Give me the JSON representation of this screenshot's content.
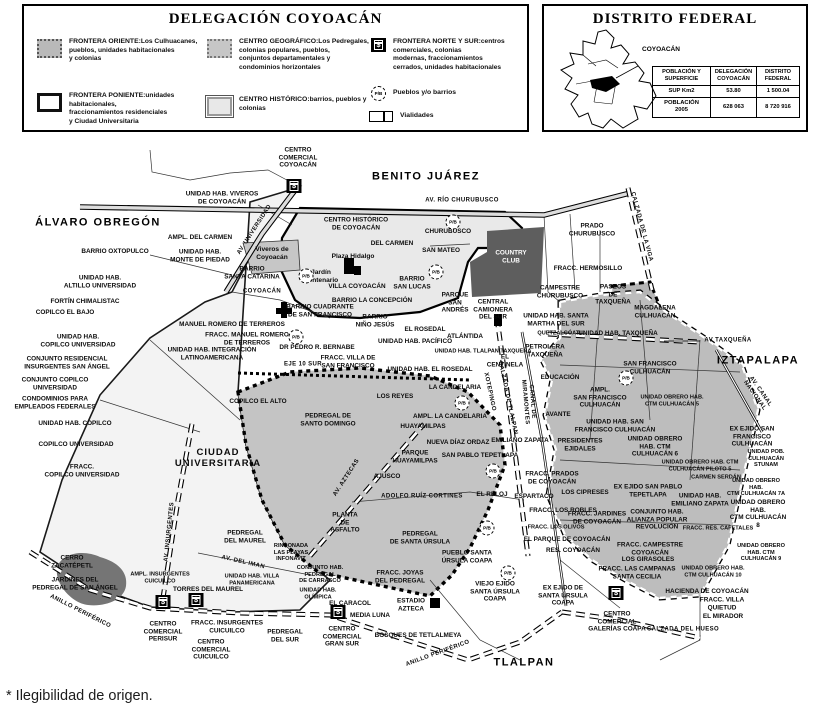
{
  "legend": {
    "title": "DELEGACIÓN COYOACÁN",
    "items": [
      {
        "title": "FRONTERA ORIENTE:",
        "desc": "Los Culhuacanes,\npueblos, unidades habitacionales\ny colonias",
        "color": "#b9b9b9"
      },
      {
        "title": "FRONTERA PONIENTE:",
        "desc": "unidades habitacionales,\nfraccionamientos residenciales\ny Ciudad Universitaria",
        "color": "#ffffff"
      },
      {
        "title": "CENTRO GEOGRÁFICO:",
        "desc": "Los Pedregales,\ncolonias populares, pueblos,\nconjuntos departamentales y\ncondominios horizontales",
        "color": "#c6c6c6"
      },
      {
        "title": "CENTRO HISTÓRICO:",
        "desc": "barrios, pueblos y colonias",
        "color": "#e8e8e8"
      },
      {
        "title": "FRONTERA NORTE Y SUR:",
        "desc": "centros comerciales, colonias\nmodernas, fraccionamientos\ncerrados, unidades habitacionales"
      },
      {
        "title": "Pueblos y/o barrios"
      },
      {
        "title": "Vialidades"
      }
    ],
    "bank_glyph": "$",
    "pb_glyph": "P/B"
  },
  "df_box": {
    "title": "DISTRITO FEDERAL",
    "map_label": "COYOACÁN",
    "table": {
      "headers": [
        "POBLACIÓN Y\nSUPERFICIE",
        "DELEGACIÓN\nCOYOACÁN",
        "DISTRITO\nFEDERAL"
      ],
      "rows": [
        [
          "SUP Km2",
          "53.80",
          "1 500.04"
        ],
        [
          "POBLACIÓN\n2005",
          "628 063",
          "8 720 916"
        ]
      ]
    }
  },
  "footnote": "* Ilegibilidad de origen.",
  "colors": {
    "frontera_oriente": "#bdbdbd",
    "centro_geografico": "#c4c4c4",
    "frontera_poniente": "#f3f3f3",
    "centro_historico": "#e9e9e9",
    "dark_zone": "#5e5e5e"
  },
  "map": {
    "labels": [
      {
        "t": "ÁLVARO OBREGÓN",
        "x": 98,
        "y": 223,
        "k": "d"
      },
      {
        "t": "BENITO JUÁREZ",
        "x": 426,
        "y": 177,
        "k": "d"
      },
      {
        "t": "IZTAPALAPA",
        "x": 758,
        "y": 361,
        "k": "d"
      },
      {
        "t": "TLALPAN",
        "x": 524,
        "y": 663,
        "k": "d"
      },
      {
        "t": "CIUDAD\nUNIVERSITARIA",
        "x": 218,
        "y": 458,
        "k": "d2"
      },
      {
        "t": "CENTRO\nCOMERCIAL\nCOYOACÁN",
        "x": 298,
        "y": 158
      },
      {
        "t": "UNIDAD HAB. VIVEROS\nDE COYOACÁN",
        "x": 222,
        "y": 198
      },
      {
        "t": "AMPL. DEL CARMEN",
        "x": 200,
        "y": 238
      },
      {
        "t": "BARRIO OXTOPULCO",
        "x": 115,
        "y": 252
      },
      {
        "t": "UNIDAD HAB.\nMONTE DE PIEDAD",
        "x": 200,
        "y": 256
      },
      {
        "t": "UNIDAD HAB.\nALTILLO UNIVERSIDAD",
        "x": 100,
        "y": 282
      },
      {
        "t": "Viveros de\nCoyoacán",
        "x": 272,
        "y": 254,
        "k": "p"
      },
      {
        "t": "BARRIO\nSANTA CATARINA",
        "x": 252,
        "y": 273
      },
      {
        "t": "FORTÍN CHIMALISTAC",
        "x": 85,
        "y": 302
      },
      {
        "t": "COPILCO EL BAJO",
        "x": 65,
        "y": 313
      },
      {
        "t": "UNIDAD HAB.\nCOPILCO UNIVERSIDAD",
        "x": 78,
        "y": 341
      },
      {
        "t": "CONJUNTO RESIDENCIAL\nINSURGENTES SAN ÁNGEL",
        "x": 67,
        "y": 363
      },
      {
        "t": "CONJUNTO COPILCO\nUNIVERSIDAD",
        "x": 55,
        "y": 384
      },
      {
        "t": "CONDOMINIOS PARA\nEMPLEADOS FEDERALES",
        "x": 55,
        "y": 403
      },
      {
        "t": "UNIDAD HAB. COPILCO",
        "x": 75,
        "y": 424
      },
      {
        "t": "COPILCO UNIVERSIDAD",
        "x": 76,
        "y": 445
      },
      {
        "t": "FRACC.\nCOPILCO UNIVERSIDAD",
        "x": 82,
        "y": 471
      },
      {
        "t": "COPILCO EL ALTO",
        "x": 258,
        "y": 402
      },
      {
        "t": "MANUEL ROMERO DE TERREROS",
        "x": 232,
        "y": 325
      },
      {
        "t": "FRACC. MANUEL ROMERO\nDE TERREROS",
        "x": 247,
        "y": 339
      },
      {
        "t": "UNIDAD HAB. INTEGRACIÓN\nLATINOAMERICANA",
        "x": 212,
        "y": 354
      },
      {
        "t": "DR PEDRO R. BERNABE",
        "x": 317,
        "y": 348
      },
      {
        "t": "CENTRO HISTÓRICO\nDE COYOACÁN",
        "x": 356,
        "y": 224
      },
      {
        "t": "DEL CARMEN",
        "x": 392,
        "y": 244
      },
      {
        "t": "CHURUBUSCO",
        "x": 448,
        "y": 232
      },
      {
        "t": "SAN MATEO",
        "x": 441,
        "y": 251
      },
      {
        "t": "Plaza Hidalgo",
        "x": 353,
        "y": 257,
        "k": "p"
      },
      {
        "t": "Jardín\nCentenario",
        "x": 321,
        "y": 277,
        "k": "p"
      },
      {
        "t": "VILLA COYOACÁN",
        "x": 357,
        "y": 287
      },
      {
        "t": "BARRIO\nSAN LUCAS",
        "x": 412,
        "y": 283
      },
      {
        "t": "BARRIO LA CONCEPCIÓN",
        "x": 372,
        "y": 301
      },
      {
        "t": "BARRIO CUADRANTE\nDE SAN FRANCISCO",
        "x": 320,
        "y": 311
      },
      {
        "t": "PARQUE\nSAN\nANDRÉS",
        "x": 455,
        "y": 303
      },
      {
        "t": "COUNTRY\nCLUB",
        "x": 511,
        "y": 257,
        "k": "w"
      },
      {
        "t": "BARRIO\nNIÑO JESÚS",
        "x": 375,
        "y": 321
      },
      {
        "t": "EL ROSEDAL",
        "x": 425,
        "y": 330
      },
      {
        "t": "UNIDAD HAB. PACÍFICO",
        "x": 415,
        "y": 342
      },
      {
        "t": "ATLÁNTIDA",
        "x": 465,
        "y": 337
      },
      {
        "t": "UNIDAD HAB. TLALPAN TAXQUEÑA",
        "x": 483,
        "y": 352,
        "k": "s"
      },
      {
        "t": "EL\nCENTINELA",
        "x": 505,
        "y": 361
      },
      {
        "t": "FRACC. VILLA DE\nSAN FRANCISCO",
        "x": 348,
        "y": 362
      },
      {
        "t": "UNIDAD HAB. EL ROSEDAL",
        "x": 430,
        "y": 370
      },
      {
        "t": "LA CANDELARIA",
        "x": 455,
        "y": 388
      },
      {
        "t": "LOS REYES",
        "x": 395,
        "y": 397
      },
      {
        "t": "AMPL. LA CANDELARIA",
        "x": 450,
        "y": 417
      },
      {
        "t": "HUAYAMILPAS",
        "x": 423,
        "y": 427
      },
      {
        "t": "PRADO\nCHURUBUSCO",
        "x": 592,
        "y": 230
      },
      {
        "t": "FRACC. HERMOSILLO",
        "x": 588,
        "y": 269
      },
      {
        "t": "CAMPESTRE\nCHURUBUSCO",
        "x": 560,
        "y": 292
      },
      {
        "t": "PASEOS\nDE\nTAXQUEÑA",
        "x": 613,
        "y": 295
      },
      {
        "t": "MAGDALENA\nCULHUACÁN",
        "x": 655,
        "y": 312
      },
      {
        "t": "CENTRAL\nCAMIONERA\nDEL SUR",
        "x": 493,
        "y": 310
      },
      {
        "t": "UNIDAD HAB. SANTA\nMARTHA DEL SUR",
        "x": 556,
        "y": 320
      },
      {
        "t": "QUETZALCÓATL",
        "x": 560,
        "y": 334,
        "k": "s"
      },
      {
        "t": "UNIDAD HAB. TAXQUEÑA",
        "x": 618,
        "y": 334
      },
      {
        "t": "PETROLERA\nTAXQUEÑA",
        "x": 545,
        "y": 351
      },
      {
        "t": "EDUCACIÓN",
        "x": 560,
        "y": 378
      },
      {
        "t": "SAN FRANCISCO\nCULHUACÁN",
        "x": 650,
        "y": 368
      },
      {
        "t": "AMPL.\nSAN FRANCISCO\nCULHUACÁN",
        "x": 600,
        "y": 398
      },
      {
        "t": "UNIDAD OBRERO HAB.\nCTM CULHUACÁN 5",
        "x": 672,
        "y": 401,
        "k": "s"
      },
      {
        "t": "AVANTE",
        "x": 558,
        "y": 415
      },
      {
        "t": "UNIDAD HAB. SAN\nFRANCISCO CULHUACÁN",
        "x": 615,
        "y": 426
      },
      {
        "t": "EX EJIDO SAN\nFRANCISCO\nCULHUACÁN",
        "x": 752,
        "y": 437
      },
      {
        "t": "UNIDAD POB.\nCULHUACÁN\nSTUNAM",
        "x": 766,
        "y": 459,
        "k": "s"
      },
      {
        "t": "UNIDAD OBRERO\nHAB. CTM\nCULHUACÁN 6",
        "x": 655,
        "y": 447
      },
      {
        "t": "UNIDAD OBRERO HAB. CTM\nCULHUACÁN PILOTO 5",
        "x": 700,
        "y": 466,
        "k": "s"
      },
      {
        "t": "CARMEN SERDÁN",
        "x": 716,
        "y": 478,
        "k": "s"
      },
      {
        "t": "UNIDAD OBRERO HAB.\nCTM CULHUACÁN 7A",
        "x": 756,
        "y": 488,
        "k": "s"
      },
      {
        "t": "EX EJIDO SAN PABLO\nTEPETLAPA",
        "x": 648,
        "y": 491
      },
      {
        "t": "UNIDAD HAB.\nEMILIANO ZAPATA",
        "x": 700,
        "y": 500
      },
      {
        "t": "PRESIDENTES\nEJIDALES",
        "x": 580,
        "y": 445
      },
      {
        "t": "EMILIANO ZAPATA",
        "x": 520,
        "y": 441
      },
      {
        "t": "FRACC. PRADOS\nDE COYOACÁN",
        "x": 552,
        "y": 478
      },
      {
        "t": "LOS CIPRESES",
        "x": 585,
        "y": 493
      },
      {
        "t": "ESPARTACO",
        "x": 534,
        "y": 497
      },
      {
        "t": "EL RELOJ",
        "x": 492,
        "y": 495
      },
      {
        "t": "FRACC. LOS ROBLES",
        "x": 563,
        "y": 511
      },
      {
        "t": "FRACC. JARDINES\nDE COYOACÁN",
        "x": 597,
        "y": 518
      },
      {
        "t": "FRACC. LOS OLIVOS",
        "x": 556,
        "y": 528,
        "k": "s"
      },
      {
        "t": "CONJUNTO HAB.\nALIANZA POPULAR\nREVOLUCIÓN",
        "x": 657,
        "y": 520
      },
      {
        "t": "UNIDAD OBRERO HAB.\nCTM CULHUACÁN 8",
        "x": 758,
        "y": 514
      },
      {
        "t": "FRACC. RES. CAFETALES",
        "x": 718,
        "y": 529,
        "k": "s"
      },
      {
        "t": "EL PARQUE DE COYOACÁN",
        "x": 567,
        "y": 540
      },
      {
        "t": "RES. COYOACÁN",
        "x": 573,
        "y": 551
      },
      {
        "t": "FRACC. CAMPESTRE\nCOYOACÁN",
        "x": 650,
        "y": 549
      },
      {
        "t": "LOS GIRASOLES",
        "x": 648,
        "y": 560
      },
      {
        "t": "UNIDAD OBRERO\nHAB. CTM\nCULHUACÁN 9",
        "x": 761,
        "y": 553,
        "k": "s"
      },
      {
        "t": "FRACC. LAS CAMPANAS\nSANTA CECILIA",
        "x": 637,
        "y": 573
      },
      {
        "t": "UNIDAD OBRERO HAB.\nCTM CULHUACÁN 10",
        "x": 713,
        "y": 572,
        "k": "s"
      },
      {
        "t": "EX EJIDO DE\nSANTA ÚRSULA\nCOAPA",
        "x": 563,
        "y": 596
      },
      {
        "t": "CENTRO\nCOMERCIAL\nGALERÍAS COAPA",
        "x": 617,
        "y": 622
      },
      {
        "t": "HACIENDA DE COYOACÁN",
        "x": 707,
        "y": 592
      },
      {
        "t": "FRACC. VILLA\nQUIETUD",
        "x": 722,
        "y": 604
      },
      {
        "t": "EL MIRADOR",
        "x": 723,
        "y": 617
      },
      {
        "t": "VIEJO EJIDO\nSANTA ÚRSULA\nCOAPA",
        "x": 495,
        "y": 592
      },
      {
        "t": "PEDREGAL DE\nSANTO DOMINGO",
        "x": 328,
        "y": 420
      },
      {
        "t": "NUEVA DÍAZ ORDAZ",
        "x": 458,
        "y": 443
      },
      {
        "t": "PARQUE\nHUAYAMILPAS",
        "x": 415,
        "y": 457
      },
      {
        "t": "SAN PABLO TEPETLAPA",
        "x": 480,
        "y": 456
      },
      {
        "t": "AJUSCO",
        "x": 387,
        "y": 477
      },
      {
        "t": "ADOLFO RUÍZ CORTINES",
        "x": 422,
        "y": 497,
        "k": "r"
      },
      {
        "t": "PLANTA\nDE\nASFALTO",
        "x": 345,
        "y": 523
      },
      {
        "t": "PEDREGAL\nDE SANTA ÚRSULA",
        "x": 420,
        "y": 538
      },
      {
        "t": "PUEBLO SANTA\nÚRSULA COAPA",
        "x": 467,
        "y": 557
      },
      {
        "t": "RINCONADA\nLAS PLAYAS\nINFONAVIT",
        "x": 291,
        "y": 553,
        "k": "s"
      },
      {
        "t": "PEDREGAL\nDEL MAUREL",
        "x": 245,
        "y": 537
      },
      {
        "t": "CERRO\nZACATÉPETL",
        "x": 72,
        "y": 562
      },
      {
        "t": "JARDINES DEL\nPEDREGAL DE SAN ÁNGEL",
        "x": 75,
        "y": 584
      },
      {
        "t": "AMPL. INSURGENTES\nCUICUILCO",
        "x": 160,
        "y": 578,
        "k": "s"
      },
      {
        "t": "TORRES DEL MAUREL",
        "x": 208,
        "y": 590
      },
      {
        "t": "UNIDAD HAB. VILLA\nPANAMERICANA",
        "x": 252,
        "y": 580,
        "k": "s"
      },
      {
        "t": "CONJUNTO HAB.\nPEDREGAL\nDE CARRASCO",
        "x": 320,
        "y": 575,
        "k": "s"
      },
      {
        "t": "UNIDAD HAB.\nOLÍMPICA",
        "x": 318,
        "y": 594,
        "k": "s"
      },
      {
        "t": "EL CARACOL",
        "x": 350,
        "y": 604
      },
      {
        "t": "MEDIA LUNA",
        "x": 370,
        "y": 616
      },
      {
        "t": "CENTRO\nCOMERCIAL\nPERISUR",
        "x": 163,
        "y": 632
      },
      {
        "t": "FRACC. INSURGENTES\nCUICUILCO",
        "x": 227,
        "y": 627
      },
      {
        "t": "CENTRO\nCOMERCIAL\nCUICUILCO",
        "x": 211,
        "y": 650
      },
      {
        "t": "CENTRO\nCOMERCIAL\nGRAN SUR",
        "x": 342,
        "y": 637
      },
      {
        "t": "PEDREGAL\nDEL SUR",
        "x": 285,
        "y": 636
      },
      {
        "t": "FRACC. JOYAS\nDEL PEDREGAL",
        "x": 400,
        "y": 577
      },
      {
        "t": "ESTADIO\nAZTECA",
        "x": 411,
        "y": 605
      },
      {
        "t": "BOSQUES DE TETLALMEYA",
        "x": 418,
        "y": 636
      },
      {
        "t": "AV. RÍO CHURUBUSCO",
        "x": 462,
        "y": 201,
        "k": "r"
      },
      {
        "t": "CALZADA DE LA VIGA",
        "x": 641,
        "y": 227,
        "k": "r",
        "r": 75
      },
      {
        "t": "AV. UNIVERSIDAD",
        "x": 255,
        "y": 230,
        "k": "r",
        "r": -57
      },
      {
        "t": "COYOACÁN",
        "x": 262,
        "y": 292,
        "k": "r"
      },
      {
        "t": "EJE 10 SUR",
        "x": 303,
        "y": 365,
        "k": "r"
      },
      {
        "t": "AV. INSURGENTES",
        "x": 170,
        "y": 532,
        "k": "r",
        "r": -84
      },
      {
        "t": "AV. AZTECAS",
        "x": 347,
        "y": 478,
        "k": "r",
        "r": -57
      },
      {
        "t": "AV. DEL IMAN",
        "x": 243,
        "y": 563,
        "k": "r",
        "r": 13
      },
      {
        "t": "ANILLO PERIFÉRICO",
        "x": 80,
        "y": 612,
        "k": "r",
        "r": 27
      },
      {
        "t": "ANILLO PERIFÉRICO",
        "x": 438,
        "y": 654,
        "k": "r",
        "r": -20
      },
      {
        "t": "CALZADA DE TLALPAN",
        "x": 507,
        "y": 398,
        "k": "r",
        "r": 78
      },
      {
        "t": "XOTEPINGO",
        "x": 489,
        "y": 392,
        "k": "r",
        "r": 78
      },
      {
        "t": "CANAL DE\nMIRAMONTES",
        "x": 528,
        "y": 402,
        "k": "r",
        "r": 85
      },
      {
        "t": "AV TAXQUEÑA",
        "x": 728,
        "y": 341,
        "k": "r"
      },
      {
        "t": "AV. CANAL NACIONAL",
        "x": 757,
        "y": 394,
        "k": "r",
        "r": 55
      },
      {
        "t": "CALZADA DEL HUESO",
        "x": 683,
        "y": 630,
        "k": "r"
      }
    ],
    "icons": [
      {
        "type": "bank",
        "x": 294,
        "y": 186
      },
      {
        "type": "bank",
        "x": 163,
        "y": 602
      },
      {
        "type": "bank",
        "x": 196,
        "y": 600
      },
      {
        "type": "bank",
        "x": 338,
        "y": 612
      },
      {
        "type": "bank",
        "x": 616,
        "y": 593
      },
      {
        "type": "pb",
        "x": 453,
        "y": 222
      },
      {
        "type": "pb",
        "x": 306,
        "y": 276
      },
      {
        "type": "pb",
        "x": 436,
        "y": 272
      },
      {
        "type": "pb",
        "x": 296,
        "y": 337
      },
      {
        "type": "pb",
        "x": 462,
        "y": 403
      },
      {
        "type": "pb",
        "x": 493,
        "y": 471
      },
      {
        "type": "pb",
        "x": 487,
        "y": 528
      },
      {
        "type": "pb",
        "x": 508,
        "y": 573
      },
      {
        "type": "pb",
        "x": 626,
        "y": 378
      }
    ]
  }
}
